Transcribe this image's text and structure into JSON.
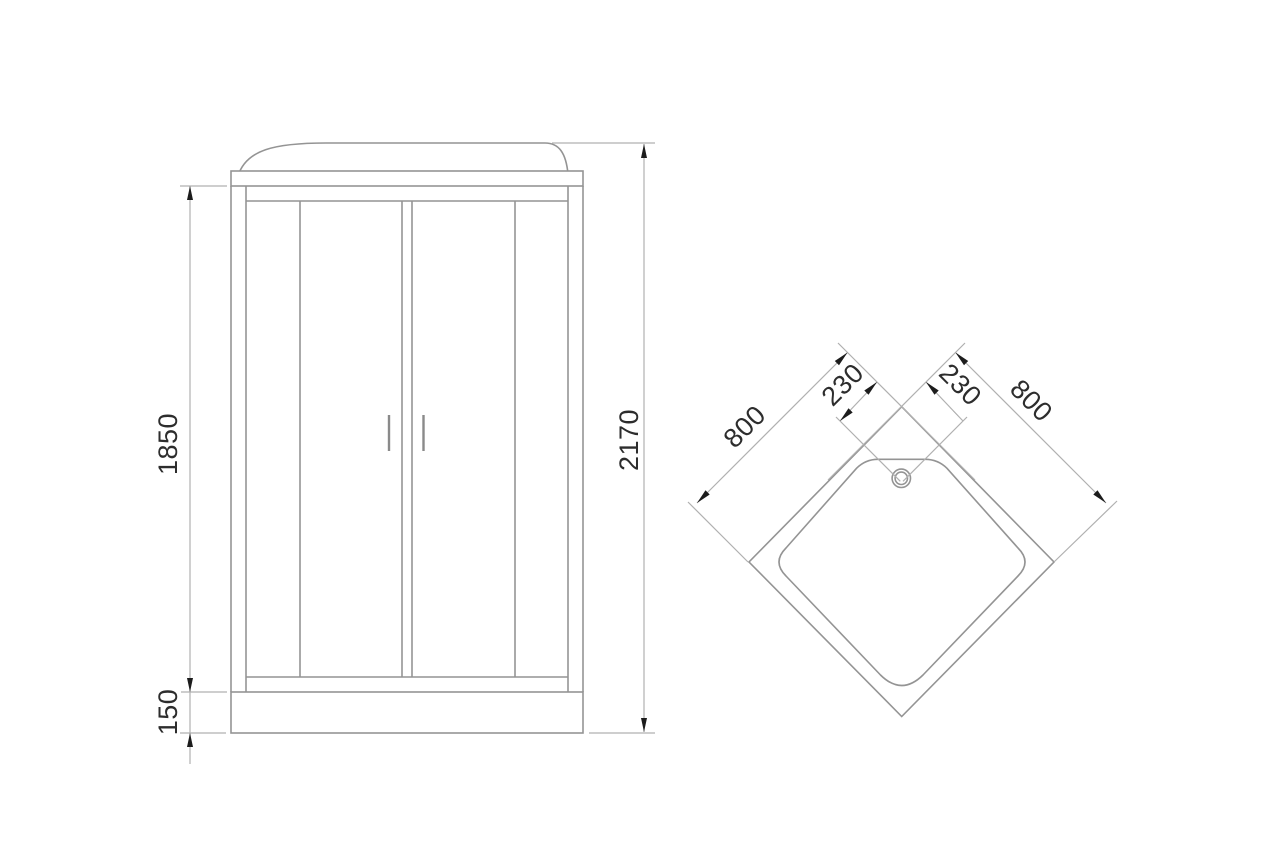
{
  "drawing_title": "Shower cabin dimensional drawing (front view and top view)",
  "front_view": {
    "glass_height_mm": "1850",
    "tray_height_mm": "150",
    "total_height_mm": "2170"
  },
  "top_view": {
    "left_side_mm": "800",
    "right_side_mm": "800",
    "left_corner_offset_mm": "230",
    "right_corner_offset_mm": "230"
  },
  "colors": {
    "background": "#ffffff",
    "object_line": "#949494",
    "dimension_line": "#b0b0b0",
    "arrow": "#1c1c1c",
    "text": "#2d2d2d"
  }
}
